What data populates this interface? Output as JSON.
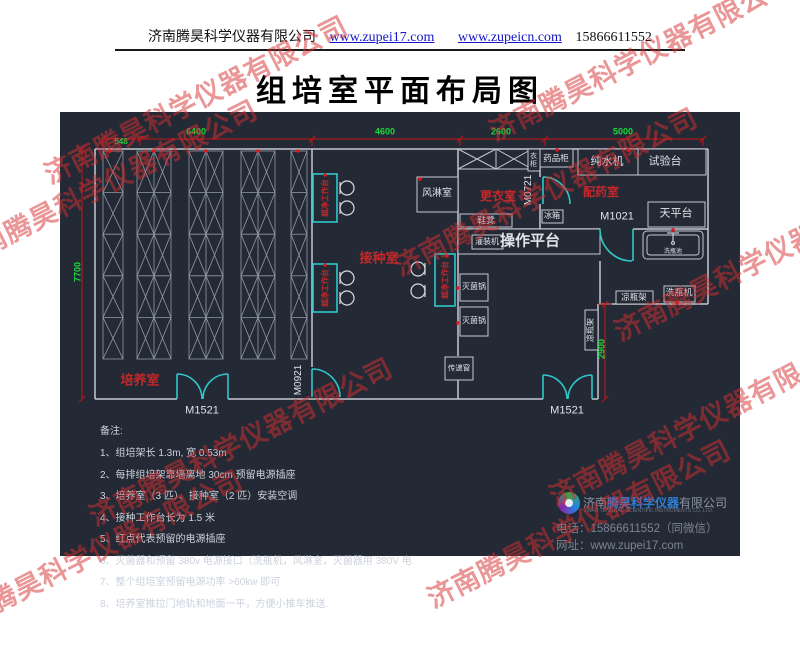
{
  "header": {
    "company": "济南腾昊科学仪器有限公司",
    "url1": "www.zupei17.com",
    "url2": "www.zupeicn.com",
    "phone": "15866611552"
  },
  "title": "组培室平面布局图",
  "watermark": {
    "text": "济南腾昊科学仪器有限公司"
  },
  "plan": {
    "dims": {
      "top": [
        "548",
        "6400",
        "4600",
        "2600",
        "5000"
      ],
      "left": "7700",
      "right": "2900"
    },
    "rooms": {
      "cultivation": "培养室",
      "inoculation": "接种室",
      "changing": "更衣室",
      "dispensing": "配药室"
    },
    "doors": {
      "m1521": "M1521",
      "m0921": "M0921",
      "m0721": "M0721",
      "m1021": "M1021"
    },
    "equipment": {
      "air_shower": "风淋室",
      "medicine_cabinet": "药品柜",
      "wardrobe": "衣柜",
      "water_purifier": "纯水机",
      "test_bench": "试验台",
      "balance_table": "天平台",
      "fridge": "冰箱",
      "shoe_bench": "鞋凳",
      "filling_machine": "灌装机",
      "operation_platform": "操作平台",
      "sterilizer": "灭菌锅",
      "transfer_window": "传递窗",
      "bottle_rack": "凉瓶架",
      "bottle_washer": "洗瓶机",
      "sink": "洗瓶池",
      "clean_bench": "超净工作台"
    }
  },
  "notes": {
    "title": "备注:",
    "items": [
      "1、组培架长 1.3m, 宽 0.53m",
      "2、每排组培架靠墙离地 30cm 预留电源插座",
      "3、培养室（3 匹）、接种室（2 匹）安装空调",
      "4、接种工作台长为 1.5 米",
      "5、红点代表预留的电源插座",
      "6、灭菌器和预留 380v 电源接口（洗瓶机，风淋室，灭菌器用 380V 电",
      "7、整个组培室预留电源功率 >60kw 即可",
      "8、培养室推拉门地轨和地面一平，方便小推车推送."
    ]
  },
  "footer": {
    "brand_prefix": "济南",
    "brand_name": "腾昊科学仪器",
    "brand_suffix": "有限公司",
    "english": "JINAN TENGHAO SCIENTIFIC INSTRUMENTS CO.,LTD.",
    "phone": "电话：15866611552（同微信）",
    "website": "网址：www.zupei17.com"
  },
  "colors": {
    "background": "#242a35",
    "wall_line": "#c3c8d2",
    "cyan_door": "#2fc7c9",
    "red_label": "#c4272a",
    "green_dim": "#1ed53c",
    "watermark_red": "#d62d30",
    "brand_blue": "#2e7fd6"
  }
}
